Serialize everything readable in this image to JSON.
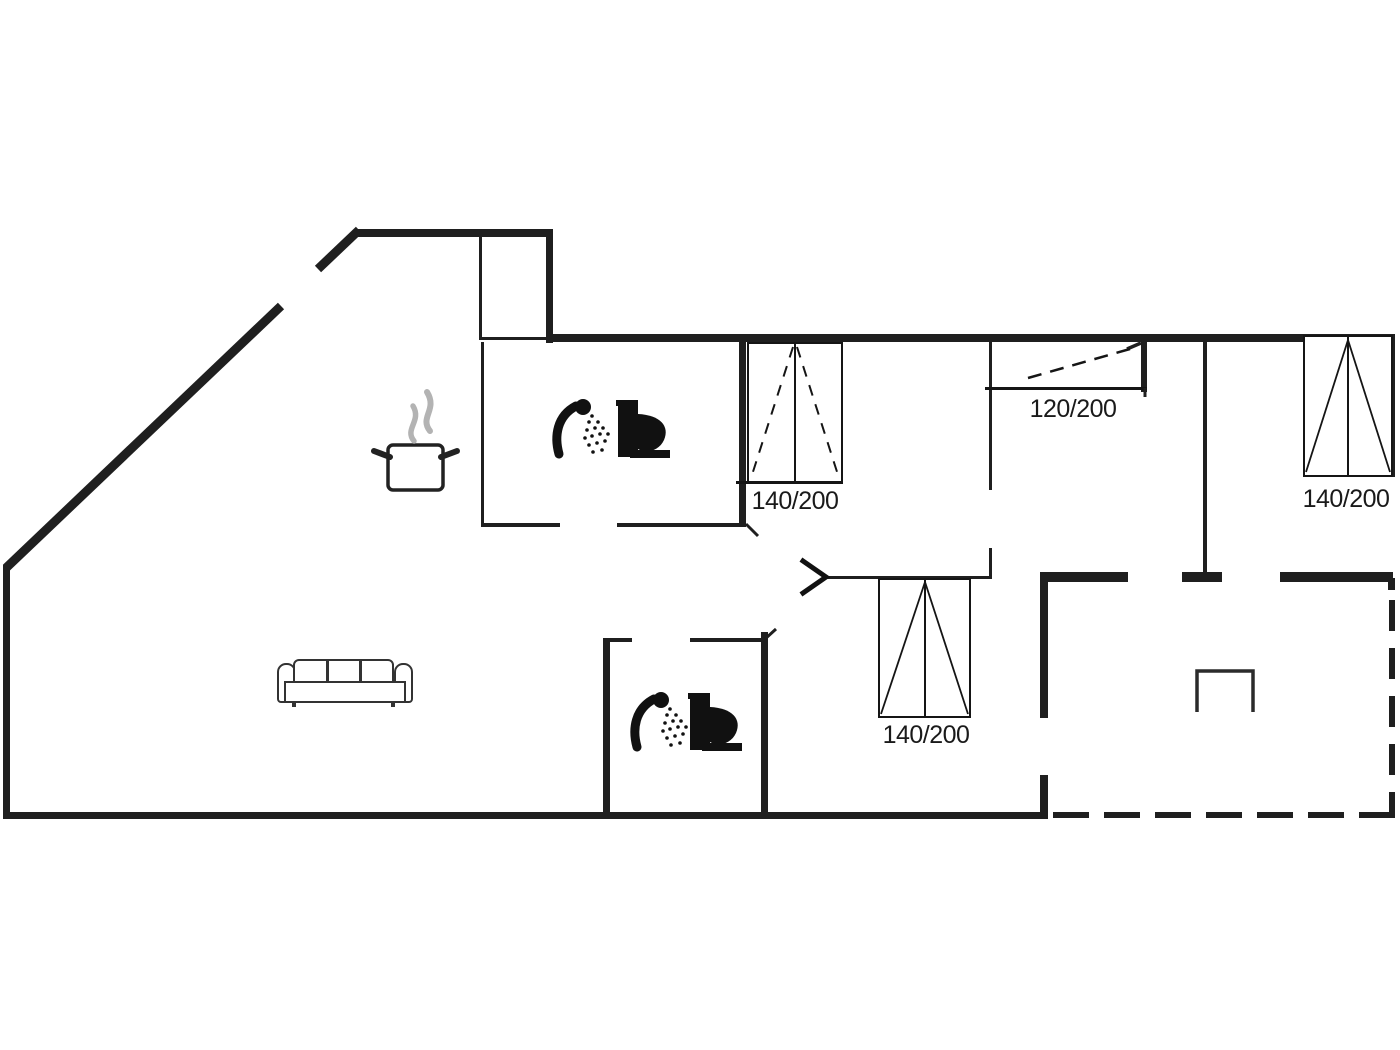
{
  "canvas": {
    "background": "#ffffff",
    "wall_color": "#1f1f1f",
    "icon_color": "#111111",
    "steam_color": "#b3b3b3",
    "text_color": "#1a1a1a"
  },
  "floorplan": {
    "type": "holiday-house-floor-plan",
    "bed_labels": [
      {
        "name": "bed-top-left",
        "label": "140/200"
      },
      {
        "name": "bed-top-middle",
        "label": "120/200"
      },
      {
        "name": "bed-top-right",
        "label": "140/200"
      },
      {
        "name": "bed-bottom-middle",
        "label": "140/200"
      }
    ],
    "icons": [
      "shower-icon",
      "toilet-icon",
      "cooking-pot-icon",
      "steam-icon",
      "sofa-icon",
      "door-chevron-icon",
      "terrace-grill-icon"
    ]
  }
}
